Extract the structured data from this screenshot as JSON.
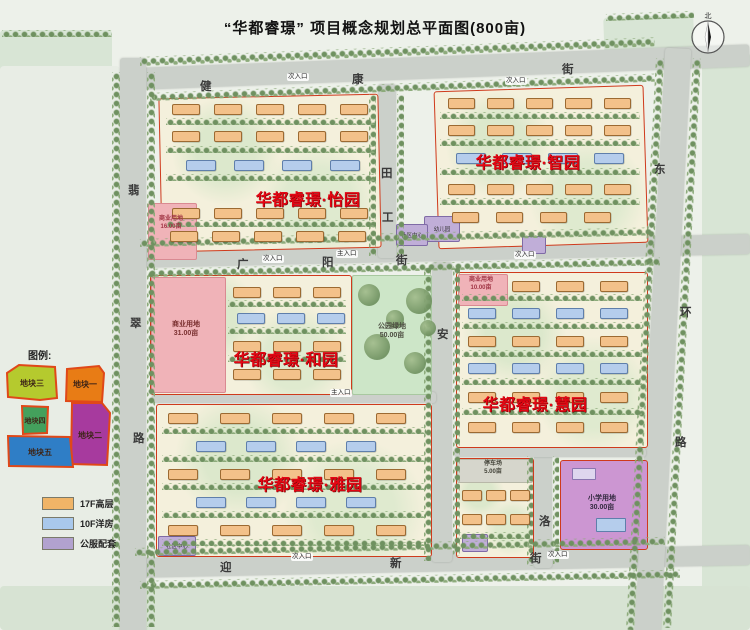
{
  "title": "“华都睿璟” 项目概念规划总平面图(800亩)",
  "compass": {
    "north_label": "北"
  },
  "streets": {
    "jiankang": {
      "name": "健康街",
      "chars": [
        "健",
        "康",
        "街"
      ]
    },
    "guangyang": {
      "name": "广阳街",
      "chars": [
        "广",
        "阳",
        "街"
      ]
    },
    "yingxin": {
      "name": "迎新街",
      "chars": [
        "迎",
        "新",
        "街"
      ]
    },
    "feicui": {
      "name": "翡翠路",
      "chars": [
        "翡",
        "翠",
        "路"
      ]
    },
    "donghuan": {
      "name": "东环路",
      "chars": [
        "东",
        "环",
        "路"
      ]
    },
    "mid_north": {
      "name": "",
      "chars": [
        "田",
        "工"
      ]
    },
    "mid_south": {
      "name": "",
      "chars": [
        "安"
      ]
    },
    "luo": {
      "name": "",
      "chars": [
        "洛"
      ]
    }
  },
  "districts": {
    "yiyuan": {
      "name": "华都睿璟·怡园"
    },
    "zhiyuan": {
      "name": "华都睿璟·智园"
    },
    "heyuan": {
      "name": "华都睿璟·和园"
    },
    "huiyuan": {
      "name": "华都睿璟·慧园"
    },
    "yayuan": {
      "name": "华都睿璟·雅园"
    }
  },
  "landuse": {
    "commercial_main": {
      "label": "商业用地",
      "area": "31.00亩"
    },
    "park": {
      "label": "公园绿地",
      "area": "50.00亩"
    },
    "parking": {
      "label": "停车场",
      "area": "5.00亩"
    },
    "school": {
      "label": "小学用地",
      "area": "30.00亩"
    },
    "commercial_nw": {
      "label": "商业用地",
      "area": "16.00亩"
    },
    "commercial_e": {
      "label": "商业用地",
      "area": "10.00亩"
    },
    "kindergarten": {
      "label": "幼儿园"
    },
    "community_ne": {
      "label": "社区中心"
    },
    "community_sw": {
      "label": "社区中心"
    }
  },
  "entrances": [
    "次入口",
    "次入口",
    "主入口",
    "次入口",
    "次入口",
    "主入口",
    "次入口",
    "次入口"
  ],
  "legend_blocks": {
    "title": "图例:",
    "items": [
      {
        "label": "地块三",
        "color": "#b5ca2e"
      },
      {
        "label": "地块一",
        "color": "#e87c15"
      },
      {
        "label": "地块四",
        "color": "#44a05c"
      },
      {
        "label": "地块二",
        "color": "#a73a9e"
      },
      {
        "label": "地块五",
        "color": "#2f7ec6"
      }
    ]
  },
  "legend_types": {
    "items": [
      {
        "label": "17F高层",
        "color": "#f0b467"
      },
      {
        "label": "10F洋房",
        "color": "#a9c8ec"
      },
      {
        "label": "公服配套",
        "color": "#b2a2cf"
      }
    ]
  },
  "colors": {
    "district_label": "#e30613",
    "block_outline": "#cf3a1c"
  }
}
